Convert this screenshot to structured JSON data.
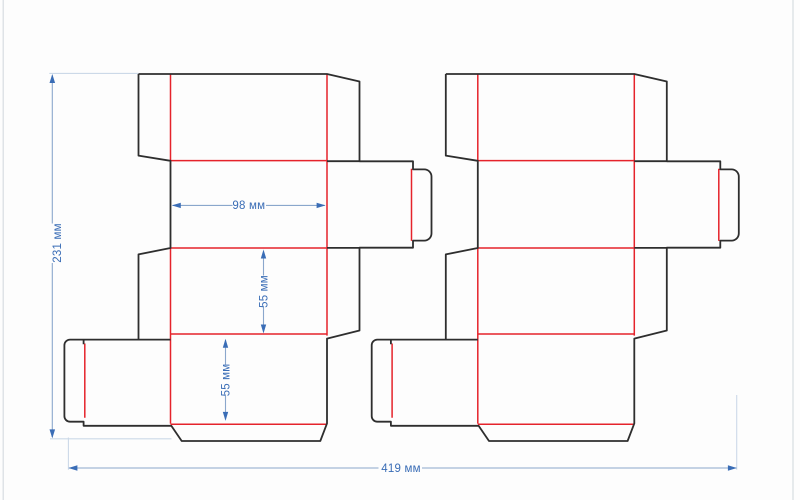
{
  "drawing": {
    "type": "packaging-dieline",
    "description": "Two identical folding-carton box blanks with cut and crease lines and dimension annotations",
    "units": "мм",
    "colors": {
      "background": "#fdfdfd",
      "cut_line": "#2e2e2e",
      "crease_line": "#e5232b",
      "dimension_accent": "#3a6db6",
      "dimension_line": "#8aa7cc",
      "extension_line": "#ccd9e8",
      "artboard_edge": "#d8dde2"
    },
    "dimensions": {
      "height": {
        "label": "231 мм",
        "value": 231,
        "unit": "мм",
        "orientation": "vertical"
      },
      "panel_width": {
        "label": "98 мм",
        "value": 98,
        "unit": "мм",
        "orientation": "horizontal"
      },
      "depth_upper": {
        "label": "55 мм",
        "value": 55,
        "unit": "мм",
        "orientation": "vertical"
      },
      "depth_lower": {
        "label": "55 мм",
        "value": 55,
        "unit": "мм",
        "orientation": "vertical"
      },
      "total_width": {
        "label": "419 мм",
        "value": 419,
        "unit": "мм",
        "orientation": "horizontal"
      }
    },
    "geometry": {
      "blank_cut": "M138.5 74 H327 L359.5 81.5 V161.3 H413 V169.4 H424.3 A7.2 7.2 0 0 1 431.5 176.6 V233.4 A7.2 7.2 0 0 1 424.3 240.6 H413 V247.7 H359.5 V330.5 L327 338.6 V423.4 L320.3 441 H181.7 L171.3 425.8 H83.6 V421.7 H70 A5.6 5.6 0 0 1 64.4 416.1 V345.2 A5.6 5.6 0 0 1 70 339.6 H170.5 M138.5 74 V155.6 L170.5 160.8 V248 L138.5 254.4 V339.6 M327 161.2 H359.5 M327 247.9 H359.5 M83.6 339.6 V344.3",
      "blank_crease": "M170.5 74 V160.6 M327 74 V335.6 M170.5 248 V423.6 M170.5 160.6 H327 M170.5 248 H327 M170.5 334 H327 M170.5 424.3 H327 M84.8 343.5 V417.7 M411.5 168.7 V240.9",
      "dim_lines": "M52.3 75.5 V223.5 M52.3 263 V437 M172.6 205.4 H232.5 M266 205.4 H324.8 M263.5 251.5 V275.5 M263.5 306.5 V331.5 M225.5 340 V364.5 M225.5 395.5 V419.5 M68.9 468 H378.5 M422 468 H736.4",
      "dim_arrows": "M52.3 74 L49.5 83 L55.1 83 Z M52.3 438.4 L49.5 429.4 L55.1 429.4 Z M171.8 205.4 L180.8 202.7 L180.8 208.1 Z M325.6 205.4 L316.6 202.7 L316.6 208.1 Z M263.5 249.5 L260.8 258.5 L266.2 258.5 Z M263.5 333.5 L260.8 324.5 L266.2 324.5 Z M225.5 338.8 L222.8 347.8 L228.2 347.8 Z M225.5 420.9 L222.8 411.9 L228.2 411.9 Z M68.4 468 L77.4 465.3 L77.4 470.7 Z M736.9 468 L727.9 465.3 L727.9 470.7 Z",
      "extension_lines": "M49.3 73.4 H138.3 M50 438.8 H171.5 M68.4 437.5 V469.7 M736.7 395 V469.7",
      "frame_lines": "M3.2 0 V500 M793 0 V500"
    }
  }
}
